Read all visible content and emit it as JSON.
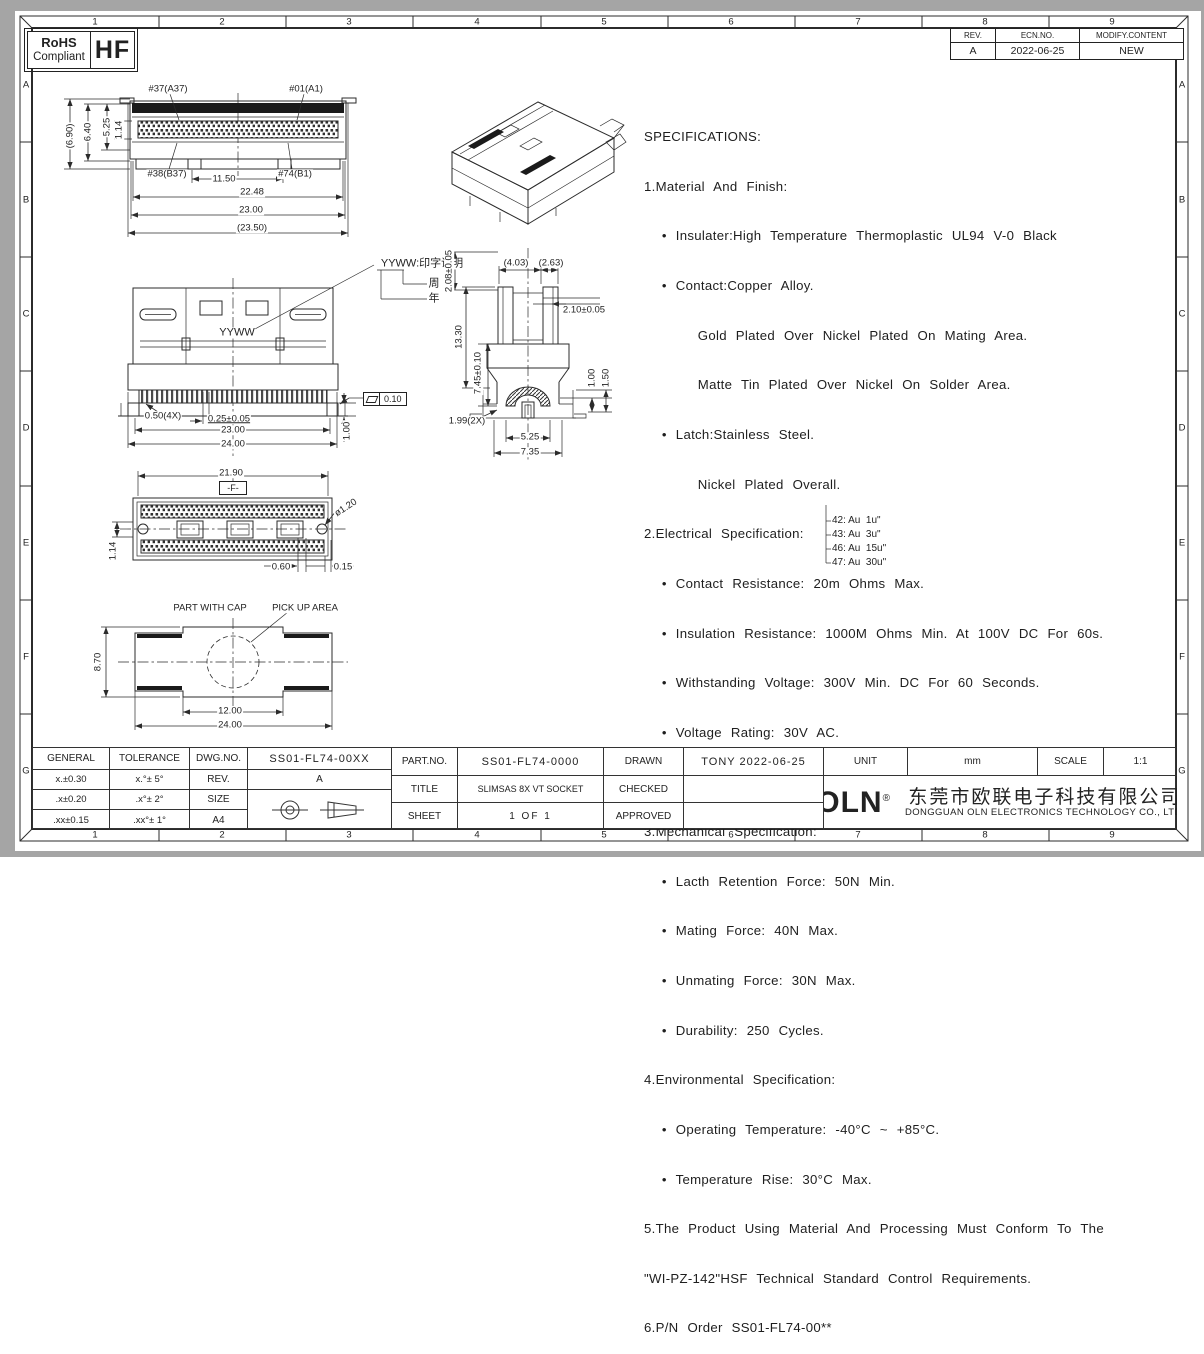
{
  "frame": {
    "cols": [
      "1",
      "2",
      "3",
      "4",
      "5",
      "6",
      "7",
      "8",
      "9"
    ],
    "rows": [
      "A",
      "B",
      "C",
      "D",
      "E",
      "F",
      "G"
    ]
  },
  "rohs": {
    "line1": "RoHS",
    "line2": "Compliant",
    "code": "HF"
  },
  "revision": {
    "rev_h": "REV.",
    "ecn_h": "ECN.NO.",
    "mod_h": "MODIFY.CONTENT",
    "rev": "A",
    "ecn": "2022-06-25",
    "mod": "NEW"
  },
  "specs": {
    "lines": [
      "SPECIFICATIONS:",
      "1.Material And Finish:",
      "  • Insulater:High Temperature Thermoplastic UL94 V-0 Black",
      "  • Contact:Copper Alloy.",
      "      Gold Plated Over Nickel Plated On Mating Area.",
      "      Matte Tin Plated Over Nickel On Solder Area.",
      "  • Latch:Stainless Steel.",
      "      Nickel Plated Overall.",
      "2.Electrical Specification:",
      "  • Contact Resistance: 20m Ohms Max.",
      "  • Insulation Resistance: 1000M Ohms Min. At 100V DC For 60s.",
      "  • Withstanding Voltage: 300V Min. DC For 60 Seconds.",
      "  • Voltage Rating: 30V AC.",
      "  • Current Rating: 0.5A Per Pin.",
      "3.Mechanical Specification:",
      "  • Lacth Retention Force: 50N Min.",
      "  • Mating Force: 40N Max.",
      "  • Unmating Force: 30N Max.",
      "  • Durability: 250 Cycles.",
      "4.Environmental Specification:",
      "  • Operating Temperature: -40°C ~ +85°C.",
      "  • Temperature Rise: 30°C Max.",
      "5.The Product Using Material And Processing Must Conform To The",
      "\"WI-PZ-142\"HSF Technical Standard Control Requirements.",
      "6.P/N Order SS01-FL74-00**"
    ],
    "pn_options": [
      "42: Au  1u\"",
      "43: Au  3u\"",
      "46: Au  15u\"",
      "47: Au  30u\""
    ]
  },
  "views": {
    "top": {
      "pin1": "#37(A37)",
      "pin2": "#01(A1)",
      "pin3": "#38(B37)",
      "pin4": "#74(B1)",
      "h_total": "(6.90)",
      "h1": "6.40",
      "h2": "5.25",
      "h3": "1.14",
      "w1": "11.50",
      "w2": "22.48",
      "w3": "23.00",
      "w4": "(23.50)"
    },
    "front": {
      "marking": "YYWW",
      "callout": "YYWW:印字说明",
      "week": "周",
      "year": "年",
      "d1": "0.50(4X)",
      "d2": "0.25±0.05",
      "d3": "23.00",
      "d4": "24.00",
      "d5": "1.00",
      "flatness": "0.10"
    },
    "side": {
      "d1": "2.08±0.05",
      "d2": "(4.03)",
      "d3": "(2.63)",
      "d4": "2.10±0.05",
      "d5": "13.30",
      "d6": "7.45±0.10",
      "d7": "1.00",
      "d8": "1.50",
      "d9": "1.99(2X)",
      "d10": "5.25",
      "d11": "7.35"
    },
    "bottom": {
      "d1": "21.90",
      "datum": "-F-",
      "d2": "ø1.20",
      "d3": "1.14",
      "d4": "0.60",
      "d5": "0.15"
    },
    "cap": {
      "label1": "PART WITH CAP",
      "label2": "PICK UP AREA",
      "d1": "8.70",
      "d2": "12.00",
      "d3": "24.00"
    }
  },
  "title_block": {
    "general_h": "GENERAL",
    "tolerance_h": "TOLERANCE",
    "tol": [
      [
        "x.±0.30",
        "x.°± 5°"
      ],
      [
        ".x±0.20",
        ".x°± 2°"
      ],
      [
        ".xx±0.15",
        ".xx°± 1°"
      ]
    ],
    "dwg_label": "DWG.NO.",
    "dwg_no": "SS01-FL74-00XX",
    "rev_label": "REV.",
    "rev": "A",
    "size_label": "SIZE",
    "size": "A4",
    "part_label": "PART.NO.",
    "part_no": "SS01-FL74-0000",
    "title_label": "TITLE",
    "title": "SLIMSAS 8X VT SOCKET",
    "sheet_label": "SHEET",
    "sheet": "1 OF 1",
    "drawn_label": "DRAWN",
    "drawn": "TONY 2022-06-25",
    "checked_label": "CHECKED",
    "approved_label": "APPROVED",
    "unit_label": "UNIT",
    "unit": "mm",
    "scale_label": "SCALE",
    "scale": "1:1",
    "logo": "OLN",
    "logo_reg": "®",
    "company_cn": "东莞市欧联电子科技有限公司",
    "company_en": "DONGGUAN OLN ELECTRONICS TECHNOLOGY CO., LTD."
  }
}
